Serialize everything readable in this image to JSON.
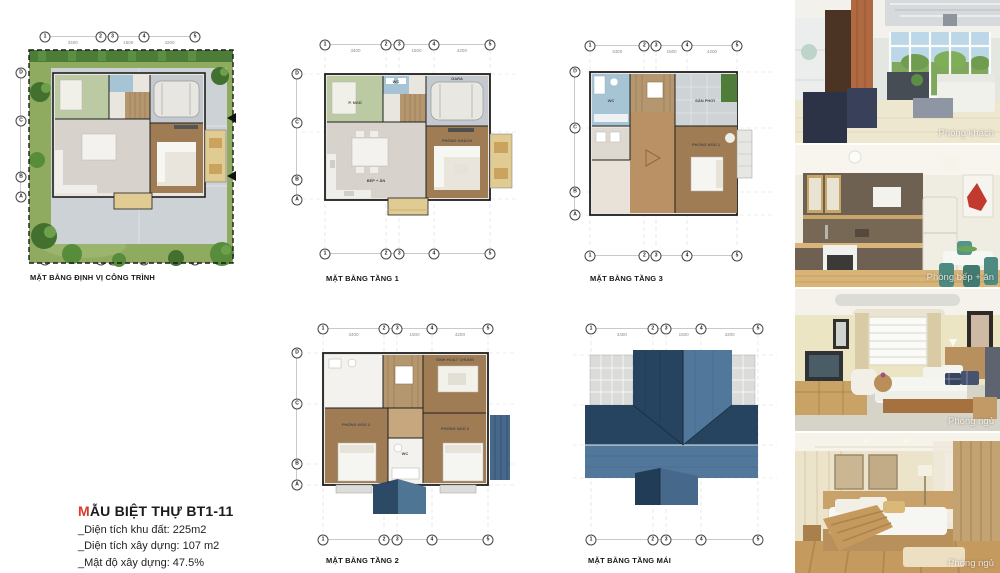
{
  "title_block": {
    "accent_letter": "M",
    "title_rest": "ẪU BIỆT THỰ BT1-11",
    "accent_color": "#d93a2e",
    "details": [
      "_Diện tích khu đất: 225m2",
      "_Diện tích xây dựng: 107 m2",
      "_Mật độ xây dựng: 47.5%"
    ]
  },
  "plans": {
    "site": {
      "caption": "MẶT BẰNG ĐỊNH VỊ CÔNG TRÌNH"
    },
    "floor1": {
      "caption": "MẶT BẰNG TẦNG 1",
      "rooms": {
        "bedroom": "P. NGỦ",
        "bath": "WC",
        "garage": "GARA",
        "kitchen": "BẾP + ĂN",
        "living": "PHÒNG KHÁCH"
      }
    },
    "floor3": {
      "caption": "MẶT BẰNG TẦNG 3",
      "rooms": {
        "terrace": "SÂN PHƠI",
        "bedroom": "PHÒNG NGỦ 1",
        "bath": "WC"
      }
    },
    "floor2": {
      "caption": "MẶT BẰNG TẦNG 2",
      "rooms": {
        "family": "SINH HOẠT CHUNG",
        "bedroom_left": "PHÒNG NGỦ 2",
        "bedroom_right": "PHÒNG NGỦ 3",
        "bath": "WC"
      }
    },
    "roof": {
      "caption": "MẶT BẰNG TẦNG MÁI"
    }
  },
  "grid": {
    "columns": [
      "1",
      "2",
      "3",
      "4",
      "5"
    ],
    "columns_pos": [
      0,
      0.37,
      0.45,
      0.66,
      1
    ],
    "rows": [
      "D",
      "C",
      "B",
      "A"
    ],
    "rows_pos": [
      0,
      0.39,
      0.84,
      1
    ],
    "dims_top": [
      {
        "label": "3400",
        "pos": 0.185
      },
      {
        "label": "1500",
        "pos": 0.555
      },
      {
        "label": "4200",
        "pos": 0.83
      }
    ]
  },
  "photos": [
    {
      "label": "Phòng khách"
    },
    {
      "label": "Phòng bếp + ăn"
    },
    {
      "label": "Phòng ngủ"
    },
    {
      "label": "Phòng ngủ"
    }
  ],
  "palette": {
    "roof_dark": "#26445f",
    "roof_mid": "#51779a",
    "wood_floor": "#a07c55",
    "tile_floor": "#d7d3cc",
    "lawn_green": "#8fab60",
    "paving_gray": "#ccd2d6",
    "bath_blue": "#a6c4d4",
    "bedroom_green": "#bccaa4",
    "porch_yellow": "#e0cb92",
    "accent_red": "#d93a2e"
  }
}
